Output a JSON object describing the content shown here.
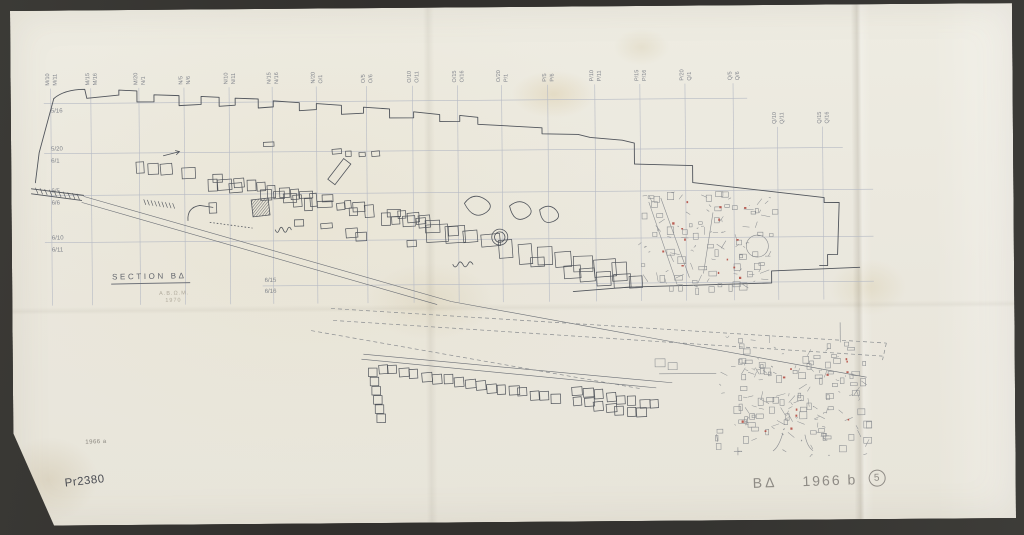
{
  "document": {
    "section_title": "SECTION ΒΔ",
    "pencil_note_line1": "Α.Β.Ω.Μ.",
    "pencil_note_line2": "1970",
    "corner_note": "1966 a",
    "catalog_number": "Pr2380",
    "bottom_right_code": "ΒΔ",
    "bottom_right_year": "1966 b",
    "bottom_right_circled": "5"
  },
  "grid": {
    "top_labels": [
      {
        "left": "M/10",
        "right": "M/11"
      },
      {
        "left": "M/15",
        "right": "M/16"
      },
      {
        "left": "M/20",
        "right": "N/1"
      },
      {
        "left": "N/5",
        "right": "N/6"
      },
      {
        "left": "N/10",
        "right": "N/11"
      },
      {
        "left": "N/15",
        "right": "N/16"
      },
      {
        "left": "N/20",
        "right": "O/1"
      },
      {
        "left": "O/5",
        "right": "O/6"
      },
      {
        "left": "O/10",
        "right": "O/11"
      },
      {
        "left": "O/15",
        "right": "O/16"
      },
      {
        "left": "O/20",
        "right": "P/1"
      },
      {
        "left": "P/5",
        "right": "P/6"
      },
      {
        "left": "P/10",
        "right": "P/11"
      },
      {
        "left": "P/15",
        "right": "P/16"
      },
      {
        "left": "P/20",
        "right": "Q/1"
      },
      {
        "left": "Q/5",
        "right": "Q/6"
      },
      {
        "left": "Q/10",
        "right": "Q/11"
      },
      {
        "left": "Q/15",
        "right": "Q/16"
      }
    ],
    "left_labels": [
      {
        "above": "",
        "below": "5/16"
      },
      {
        "above": "5/20",
        "below": "6/1"
      },
      {
        "above": "6/5",
        "below": "6/6"
      },
      {
        "above": "6/10",
        "below": "6/11"
      }
    ],
    "inner_label": {
      "above": "6/15",
      "below": "6/16"
    }
  },
  "colors": {
    "paper": "#eae7dd",
    "mat": "#333230",
    "grid_line": "#b6bac4",
    "ink": "#50545b",
    "pencil": "#8a8d91",
    "red_mark": "#b2453c"
  }
}
